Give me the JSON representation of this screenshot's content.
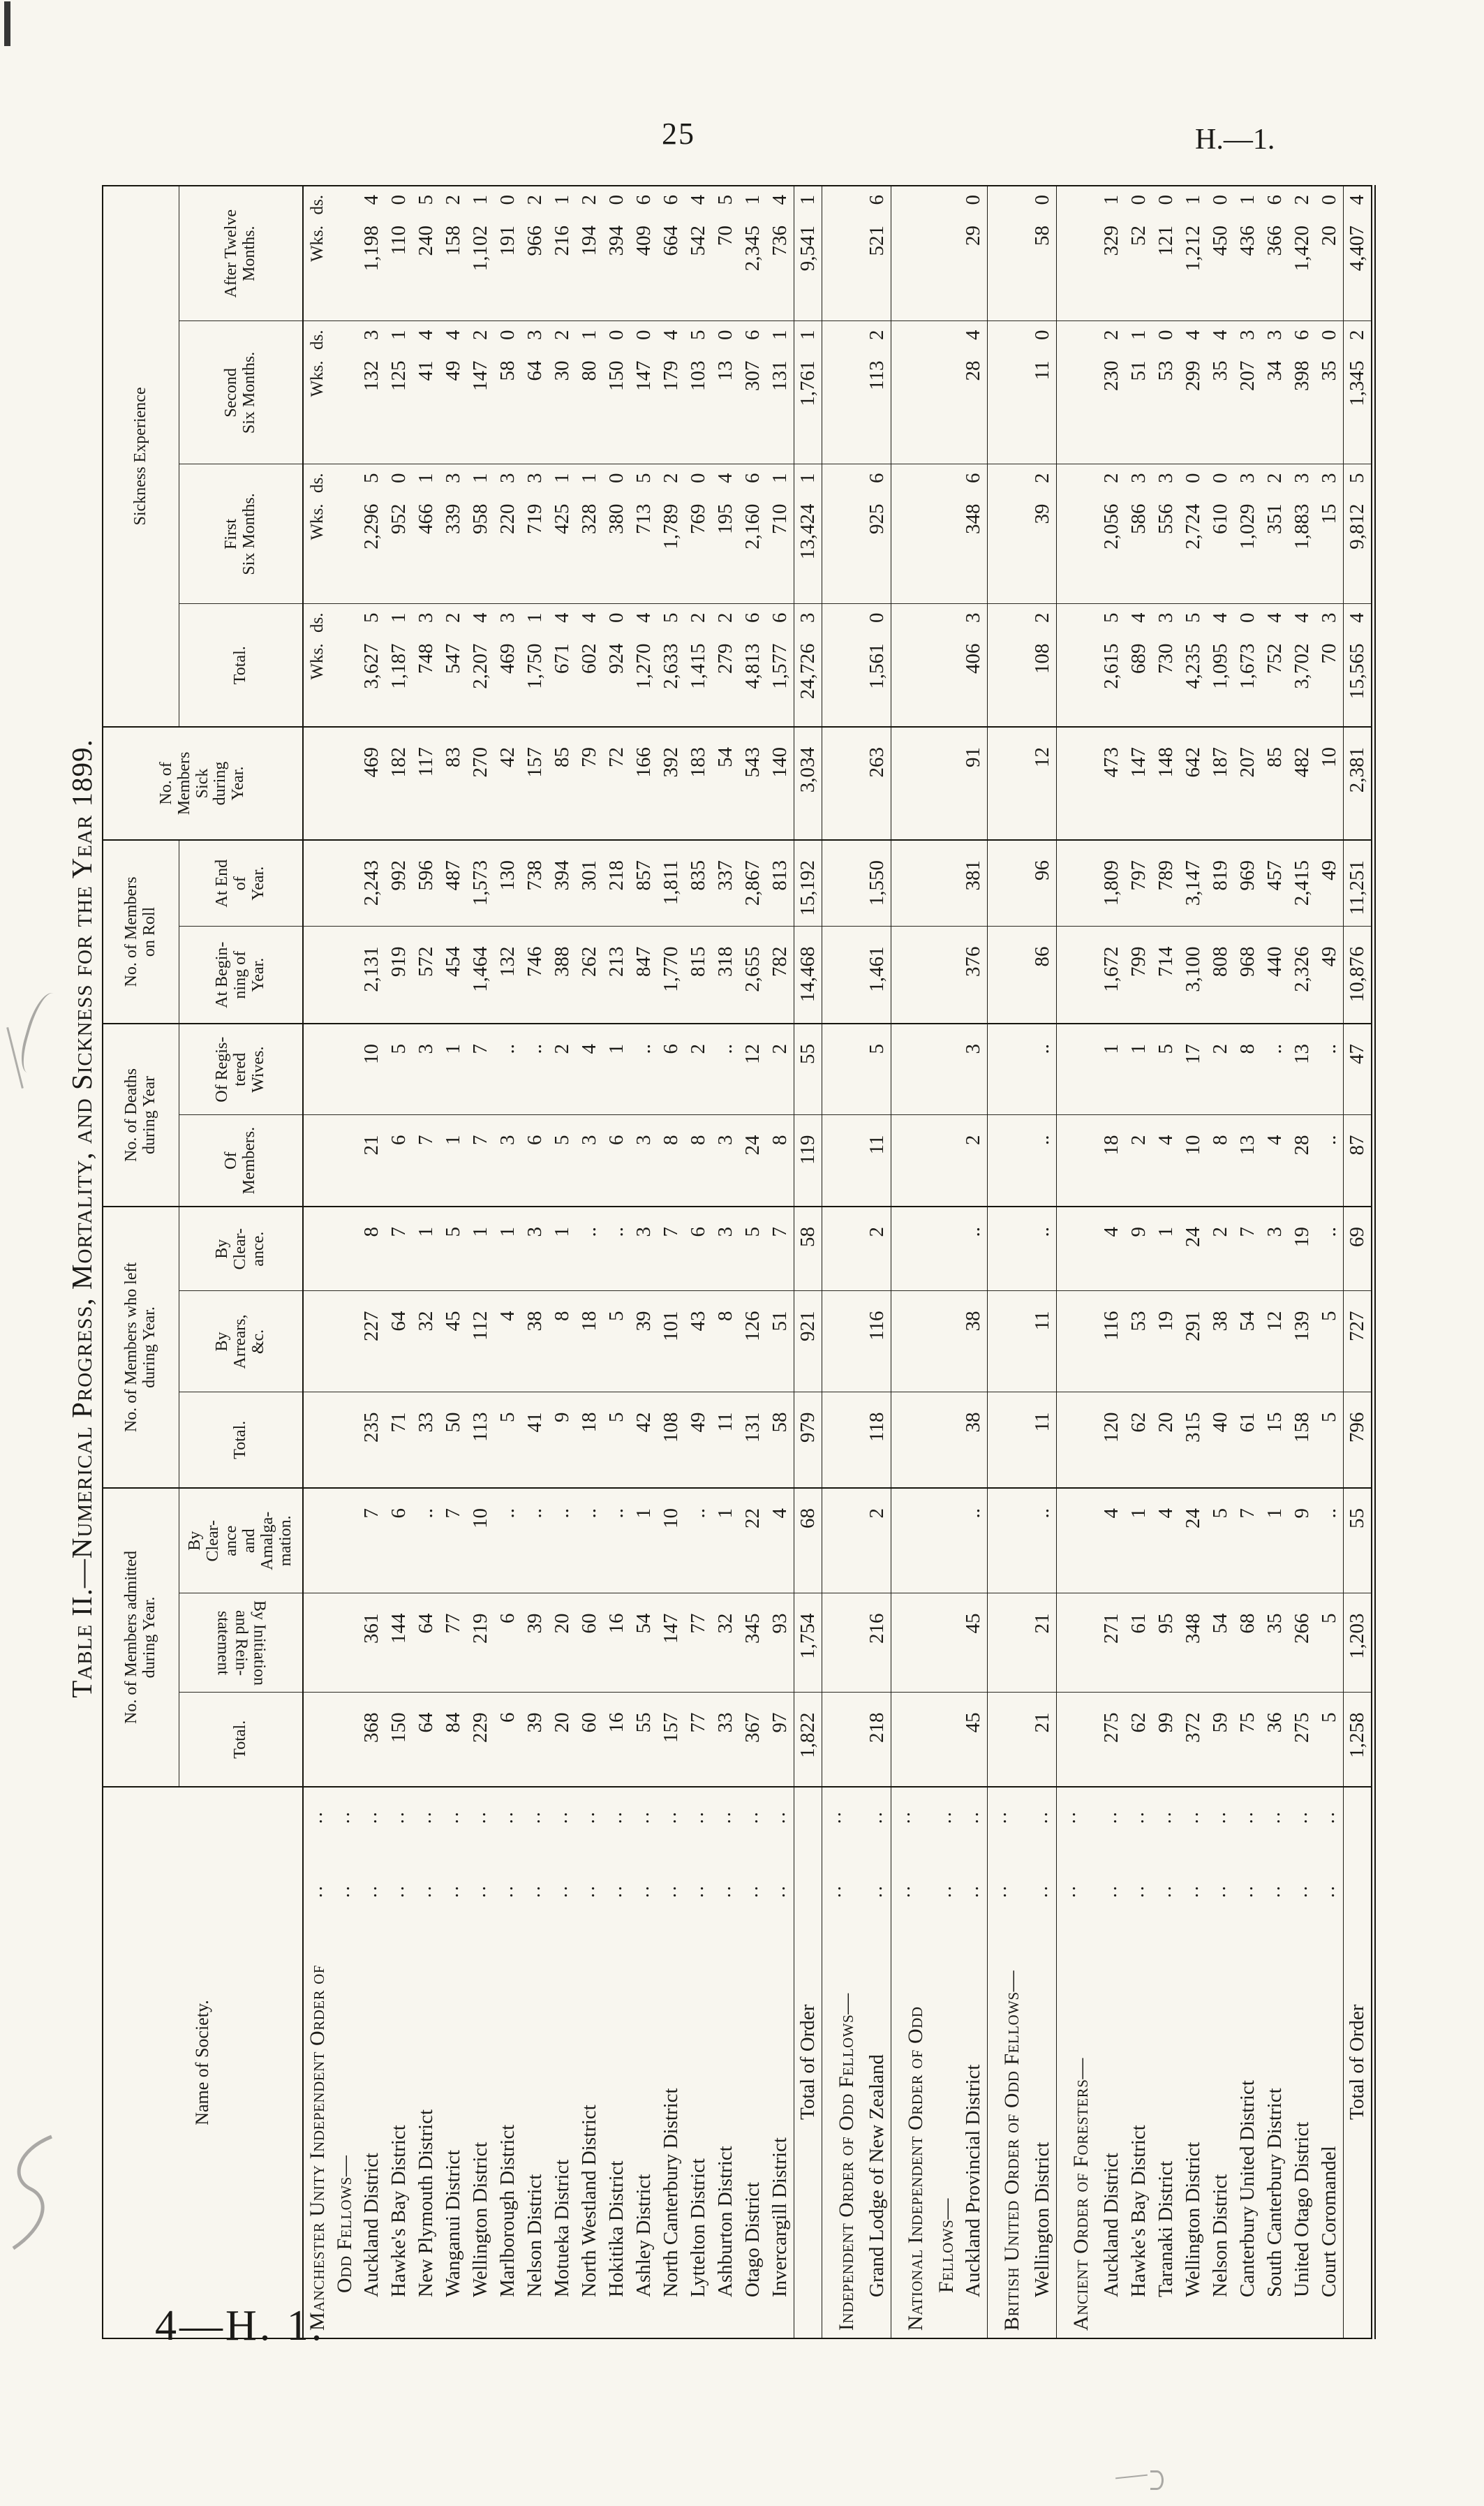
{
  "page": {
    "number": "25",
    "doc_ref": "H.—1.",
    "footer": "4—H. 1.",
    "title": "Table II.—Numerical Progress, Mortality, and Sickness for the Year 1899."
  },
  "table": {
    "header": {
      "name": "Name of Society.",
      "admitted": {
        "title": "No. of Members admitted\nduring Year.",
        "subs": [
          "Total.",
          "By Initiation\nand Rein-\nstatement",
          "By\nClear-\nance\nand\nAmalga-\nmation."
        ]
      },
      "left": {
        "title": "No. of Members who left\nduring Year.",
        "subs": [
          "Total.",
          "By\nArrears,\n&c.",
          "By\nClear-\nance."
        ]
      },
      "deaths": {
        "title": "No. of Deaths\nduring Year",
        "subs": [
          "Of\nMembers.",
          "Of Regis-\ntered\nWives."
        ]
      },
      "roll": {
        "title": "No. of Members\non Roll",
        "subs": [
          "At Begin-\nning of\nYear.",
          "At End\nof\nYear."
        ]
      },
      "sick": "No. of\nMembers\nSick\nduring\nYear.",
      "sickness": {
        "title": "Sickness Experience",
        "subs": [
          "Total.",
          "First\nSix Months.",
          "Second\nSix Months.",
          "After Twelve\nMonths."
        ],
        "wks": "Wks.",
        "ds": "ds."
      },
      "leader_dots": ".."
    },
    "rows": [
      {
        "type": "g",
        "name": "Manchester Unity Independent Order of",
        "wks": true
      },
      {
        "type": "g2",
        "name": "Odd Fellows—"
      },
      {
        "type": "d",
        "name": "Auckland District",
        "c": [
          "368",
          "361",
          "7",
          "235",
          "227",
          "8",
          "21",
          "10",
          "2,131",
          "2,243",
          "469"
        ],
        "s": [
          [
            "3,627",
            "5"
          ],
          [
            "2,296",
            "5"
          ],
          [
            "132",
            "3"
          ],
          [
            "1,198",
            "4"
          ]
        ]
      },
      {
        "type": "d",
        "name": "Hawke's Bay District",
        "c": [
          "150",
          "144",
          "6",
          "71",
          "64",
          "7",
          "6",
          "5",
          "919",
          "992",
          "182"
        ],
        "s": [
          [
            "1,187",
            "1"
          ],
          [
            "952",
            "0"
          ],
          [
            "125",
            "1"
          ],
          [
            "110",
            "0"
          ]
        ]
      },
      {
        "type": "d",
        "name": "New Plymouth District",
        "c": [
          "64",
          "64",
          "..",
          "33",
          "32",
          "1",
          "7",
          "3",
          "572",
          "596",
          "117"
        ],
        "s": [
          [
            "748",
            "3"
          ],
          [
            "466",
            "1"
          ],
          [
            "41",
            "4"
          ],
          [
            "240",
            "5"
          ]
        ]
      },
      {
        "type": "d",
        "name": "Wanganui District",
        "c": [
          "84",
          "77",
          "7",
          "50",
          "45",
          "5",
          "1",
          "1",
          "454",
          "487",
          "83"
        ],
        "s": [
          [
            "547",
            "2"
          ],
          [
            "339",
            "3"
          ],
          [
            "49",
            "4"
          ],
          [
            "158",
            "2"
          ]
        ]
      },
      {
        "type": "d",
        "name": "Wellington District",
        "c": [
          "229",
          "219",
          "10",
          "113",
          "112",
          "1",
          "7",
          "7",
          "1,464",
          "1,573",
          "270"
        ],
        "s": [
          [
            "2,207",
            "4"
          ],
          [
            "958",
            "1"
          ],
          [
            "147",
            "2"
          ],
          [
            "1,102",
            "1"
          ]
        ]
      },
      {
        "type": "d",
        "name": "Marlborough District",
        "c": [
          "6",
          "6",
          "..",
          "5",
          "4",
          "1",
          "3",
          "..",
          "132",
          "130",
          "42"
        ],
        "s": [
          [
            "469",
            "3"
          ],
          [
            "220",
            "3"
          ],
          [
            "58",
            "0"
          ],
          [
            "191",
            "0"
          ]
        ]
      },
      {
        "type": "d",
        "name": "Nelson District",
        "c": [
          "39",
          "39",
          "..",
          "41",
          "38",
          "3",
          "6",
          "..",
          "746",
          "738",
          "157"
        ],
        "s": [
          [
            "1,750",
            "1"
          ],
          [
            "719",
            "3"
          ],
          [
            "64",
            "3"
          ],
          [
            "966",
            "2"
          ]
        ]
      },
      {
        "type": "d",
        "name": "Motueka District",
        "c": [
          "20",
          "20",
          "..",
          "9",
          "8",
          "1",
          "5",
          "2",
          "388",
          "394",
          "85"
        ],
        "s": [
          [
            "671",
            "4"
          ],
          [
            "425",
            "1"
          ],
          [
            "30",
            "2"
          ],
          [
            "216",
            "1"
          ]
        ]
      },
      {
        "type": "d",
        "name": "North Westland District",
        "c": [
          "60",
          "60",
          "..",
          "18",
          "18",
          "..",
          "3",
          "4",
          "262",
          "301",
          "79"
        ],
        "s": [
          [
            "602",
            "4"
          ],
          [
            "328",
            "1"
          ],
          [
            "80",
            "1"
          ],
          [
            "194",
            "2"
          ]
        ]
      },
      {
        "type": "d",
        "name": "Hokitika District",
        "c": [
          "16",
          "16",
          "..",
          "5",
          "5",
          "..",
          "6",
          "1",
          "213",
          "218",
          "72"
        ],
        "s": [
          [
            "924",
            "0"
          ],
          [
            "380",
            "0"
          ],
          [
            "150",
            "0"
          ],
          [
            "394",
            "0"
          ]
        ]
      },
      {
        "type": "d",
        "name": "Ashley District",
        "c": [
          "55",
          "54",
          "1",
          "42",
          "39",
          "3",
          "3",
          "..",
          "847",
          "857",
          "166"
        ],
        "s": [
          [
            "1,270",
            "4"
          ],
          [
            "713",
            "5"
          ],
          [
            "147",
            "0"
          ],
          [
            "409",
            "6"
          ]
        ]
      },
      {
        "type": "d",
        "name": "North Canterbury District",
        "c": [
          "157",
          "147",
          "10",
          "108",
          "101",
          "7",
          "8",
          "6",
          "1,770",
          "1,811",
          "392"
        ],
        "s": [
          [
            "2,633",
            "5"
          ],
          [
            "1,789",
            "2"
          ],
          [
            "179",
            "4"
          ],
          [
            "664",
            "6"
          ]
        ]
      },
      {
        "type": "d",
        "name": "Lyttelton District",
        "c": [
          "77",
          "77",
          "..",
          "49",
          "43",
          "6",
          "8",
          "2",
          "815",
          "835",
          "183"
        ],
        "s": [
          [
            "1,415",
            "2"
          ],
          [
            "769",
            "0"
          ],
          [
            "103",
            "5"
          ],
          [
            "542",
            "4"
          ]
        ]
      },
      {
        "type": "d",
        "name": "Ashburton District",
        "c": [
          "33",
          "32",
          "1",
          "11",
          "8",
          "3",
          "3",
          "..",
          "318",
          "337",
          "54"
        ],
        "s": [
          [
            "279",
            "2"
          ],
          [
            "195",
            "4"
          ],
          [
            "13",
            "0"
          ],
          [
            "70",
            "5"
          ]
        ]
      },
      {
        "type": "d",
        "name": "Otago District",
        "c": [
          "367",
          "345",
          "22",
          "131",
          "126",
          "5",
          "24",
          "12",
          "2,655",
          "2,867",
          "543"
        ],
        "s": [
          [
            "4,813",
            "6"
          ],
          [
            "2,160",
            "6"
          ],
          [
            "307",
            "6"
          ],
          [
            "2,345",
            "1"
          ]
        ]
      },
      {
        "type": "d",
        "name": "Invercargill District",
        "c": [
          "97",
          "93",
          "4",
          "58",
          "51",
          "7",
          "8",
          "2",
          "782",
          "813",
          "140"
        ],
        "s": [
          [
            "1,577",
            "6"
          ],
          [
            "710",
            "1"
          ],
          [
            "131",
            "1"
          ],
          [
            "736",
            "4"
          ]
        ]
      },
      {
        "type": "t",
        "name": "Total of Order",
        "c": [
          "1,822",
          "1,754",
          "68",
          "979",
          "921",
          "58",
          "119",
          "55",
          "14,468",
          "15,192",
          "3,034"
        ],
        "s": [
          [
            "24,726",
            "3"
          ],
          [
            "13,424",
            "1"
          ],
          [
            "1,761",
            "1"
          ],
          [
            "9,541",
            "1"
          ]
        ]
      },
      {
        "type": "g",
        "name": "Independent Order of Odd Fellows—",
        "sect": true
      },
      {
        "type": "d",
        "name": "Grand Lodge of New Zealand",
        "end": true,
        "c": [
          "218",
          "216",
          "2",
          "118",
          "116",
          "2",
          "11",
          "5",
          "1,461",
          "1,550",
          "263"
        ],
        "s": [
          [
            "1,561",
            "0"
          ],
          [
            "925",
            "6"
          ],
          [
            "113",
            "2"
          ],
          [
            "521",
            "6"
          ]
        ]
      },
      {
        "type": "g",
        "name": "National Independent Order of Odd",
        "sect": true
      },
      {
        "type": "g2",
        "name": "Fellows—"
      },
      {
        "type": "d",
        "name": "Auckland Provincial District",
        "end": true,
        "c": [
          "45",
          "45",
          "..",
          "38",
          "38",
          "..",
          "2",
          "3",
          "376",
          "381",
          "91"
        ],
        "s": [
          [
            "406",
            "3"
          ],
          [
            "348",
            "6"
          ],
          [
            "28",
            "4"
          ],
          [
            "29",
            "0"
          ]
        ]
      },
      {
        "type": "g",
        "name": "British United Order of Odd Fellows—",
        "sect": true
      },
      {
        "type": "d",
        "name": "Wellington District",
        "end": true,
        "c": [
          "21",
          "21",
          "..",
          "11",
          "11",
          "..",
          "..",
          "..",
          "86",
          "96",
          "12"
        ],
        "s": [
          [
            "108",
            "2"
          ],
          [
            "39",
            "2"
          ],
          [
            "11",
            "0"
          ],
          [
            "58",
            "0"
          ]
        ]
      },
      {
        "type": "g",
        "name": "Ancient Order of Foresters—",
        "sect": true
      },
      {
        "type": "d",
        "name": "Auckland District",
        "c": [
          "275",
          "271",
          "4",
          "120",
          "116",
          "4",
          "18",
          "1",
          "1,672",
          "1,809",
          "473"
        ],
        "s": [
          [
            "2,615",
            "5"
          ],
          [
            "2,056",
            "2"
          ],
          [
            "230",
            "2"
          ],
          [
            "329",
            "1"
          ]
        ]
      },
      {
        "type": "d",
        "name": "Hawke's Bay District",
        "c": [
          "62",
          "61",
          "1",
          "62",
          "53",
          "9",
          "2",
          "1",
          "799",
          "797",
          "147"
        ],
        "s": [
          [
            "689",
            "4"
          ],
          [
            "586",
            "3"
          ],
          [
            "51",
            "1"
          ],
          [
            "52",
            "0"
          ]
        ]
      },
      {
        "type": "d",
        "name": "Taranaki District",
        "c": [
          "99",
          "95",
          "4",
          "20",
          "19",
          "1",
          "4",
          "5",
          "714",
          "789",
          "148"
        ],
        "s": [
          [
            "730",
            "3"
          ],
          [
            "556",
            "3"
          ],
          [
            "53",
            "0"
          ],
          [
            "121",
            "0"
          ]
        ]
      },
      {
        "type": "d",
        "name": "Wellington District",
        "c": [
          "372",
          "348",
          "24",
          "315",
          "291",
          "24",
          "10",
          "17",
          "3,100",
          "3,147",
          "642"
        ],
        "s": [
          [
            "4,235",
            "5"
          ],
          [
            "2,724",
            "0"
          ],
          [
            "299",
            "4"
          ],
          [
            "1,212",
            "1"
          ]
        ]
      },
      {
        "type": "d",
        "name": "Nelson District",
        "c": [
          "59",
          "54",
          "5",
          "40",
          "38",
          "2",
          "8",
          "2",
          "808",
          "819",
          "187"
        ],
        "s": [
          [
            "1,095",
            "4"
          ],
          [
            "610",
            "0"
          ],
          [
            "35",
            "4"
          ],
          [
            "450",
            "0"
          ]
        ]
      },
      {
        "type": "d",
        "name": "Canterbury United District",
        "c": [
          "75",
          "68",
          "7",
          "61",
          "54",
          "7",
          "13",
          "8",
          "968",
          "969",
          "207"
        ],
        "s": [
          [
            "1,673",
            "0"
          ],
          [
            "1,029",
            "3"
          ],
          [
            "207",
            "3"
          ],
          [
            "436",
            "1"
          ]
        ]
      },
      {
        "type": "d",
        "name": "South Canterbury District",
        "c": [
          "36",
          "35",
          "1",
          "15",
          "12",
          "3",
          "4",
          "..",
          "440",
          "457",
          "85"
        ],
        "s": [
          [
            "752",
            "4"
          ],
          [
            "351",
            "2"
          ],
          [
            "34",
            "3"
          ],
          [
            "366",
            "6"
          ]
        ]
      },
      {
        "type": "d",
        "name": "United Otago District",
        "c": [
          "275",
          "266",
          "9",
          "158",
          "139",
          "19",
          "28",
          "13",
          "2,326",
          "2,415",
          "482"
        ],
        "s": [
          [
            "3,702",
            "4"
          ],
          [
            "1,883",
            "3"
          ],
          [
            "398",
            "6"
          ],
          [
            "1,420",
            "2"
          ]
        ]
      },
      {
        "type": "d",
        "name": "Court Coromandel",
        "c": [
          "5",
          "5",
          "..",
          "5",
          "5",
          "..",
          "..",
          "..",
          "49",
          "49",
          "10"
        ],
        "s": [
          [
            "70",
            "3"
          ],
          [
            "15",
            "3"
          ],
          [
            "35",
            "0"
          ],
          [
            "20",
            "0"
          ]
        ]
      },
      {
        "type": "t",
        "name": "Total of Order",
        "last": true,
        "c": [
          "1,258",
          "1,203",
          "55",
          "796",
          "727",
          "69",
          "87",
          "47",
          "10,876",
          "11,251",
          "2,381"
        ],
        "s": [
          [
            "15,565",
            "4"
          ],
          [
            "9,812",
            "5"
          ],
          [
            "1,345",
            "2"
          ],
          [
            "4,407",
            "4"
          ]
        ]
      }
    ]
  }
}
